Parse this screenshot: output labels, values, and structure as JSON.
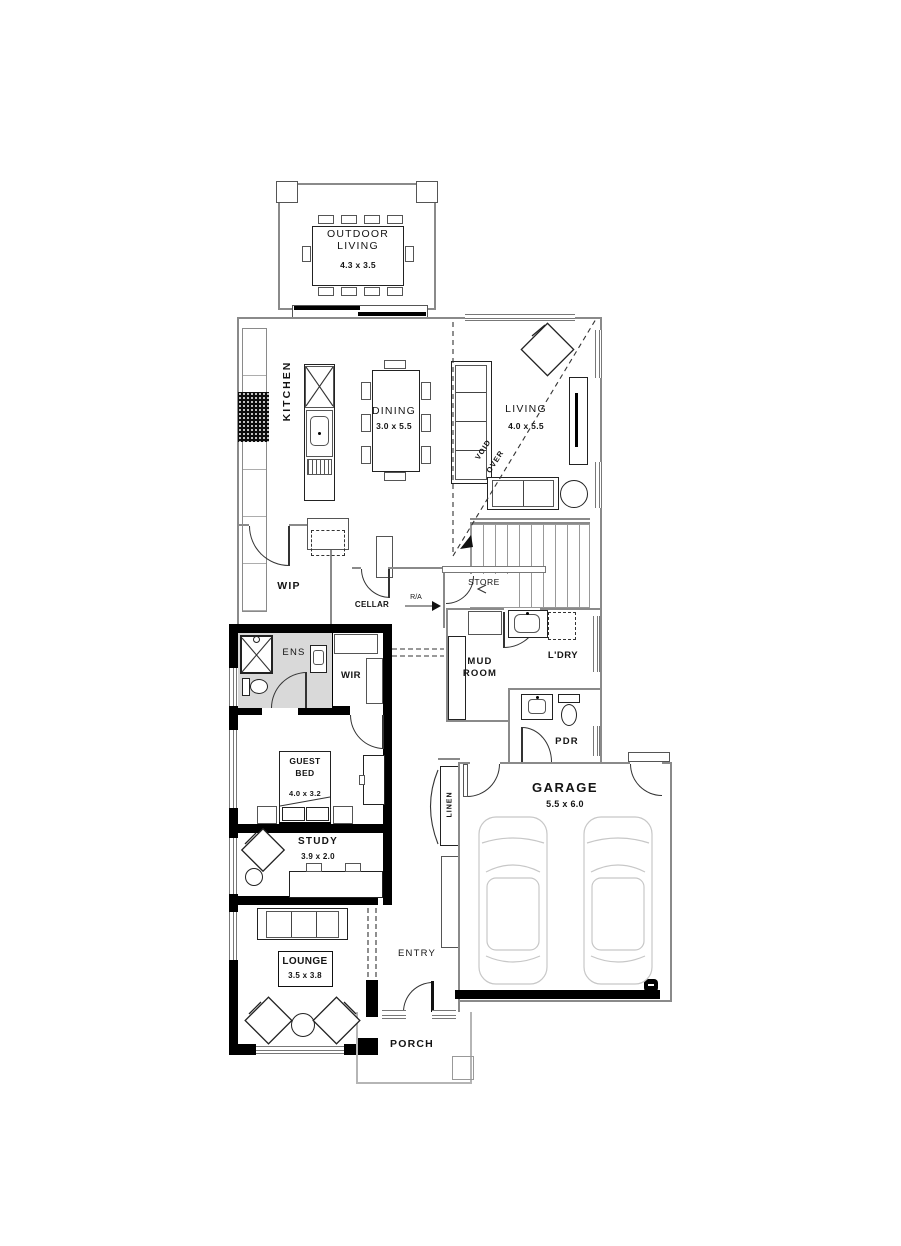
{
  "rooms": {
    "outdoor_living": {
      "line1": "OUTDOOR",
      "line2": "LIVING",
      "dims": "4.3 x 3.5"
    },
    "kitchen": {
      "label": "KITCHEN"
    },
    "dining": {
      "label": "DINING",
      "dims": "3.0 x 5.5"
    },
    "living": {
      "label": "LIVING",
      "dims": "4.0 x 5.5"
    },
    "void": {
      "line1": "VOID",
      "line2": "OVER"
    },
    "wip": {
      "label": "WIP"
    },
    "cellar": {
      "label": "CELLAR"
    },
    "store": {
      "label": "STORE"
    },
    "return_air": {
      "label": "R/A"
    },
    "ens": {
      "label": "ENS"
    },
    "wir": {
      "label": "WIR"
    },
    "mud_room": {
      "line1": "MUD",
      "line2": "ROOM"
    },
    "laundry": {
      "label": "L'DRY"
    },
    "powder": {
      "label": "PDR"
    },
    "guest_bed": {
      "line1": "GUEST",
      "line2": "BED",
      "dims": "4.0 x 3.2"
    },
    "study": {
      "label": "STUDY",
      "dims": "3.9 x 2.0"
    },
    "lounge": {
      "label": "LOUNGE",
      "dims": "3.5 x 3.8"
    },
    "entry": {
      "label": "ENTRY"
    },
    "porch": {
      "label": "PORCH"
    },
    "garage": {
      "label": "GARAGE",
      "dims": "5.5 x 6.0"
    },
    "linen": {
      "label": "LINEN"
    }
  },
  "colors": {
    "wall_black": "#000000",
    "wall_thin": "#8a8a8a",
    "furniture_line": "#222222",
    "car_line": "#c7c7c7",
    "ens_floor": "#d9d9d9"
  }
}
